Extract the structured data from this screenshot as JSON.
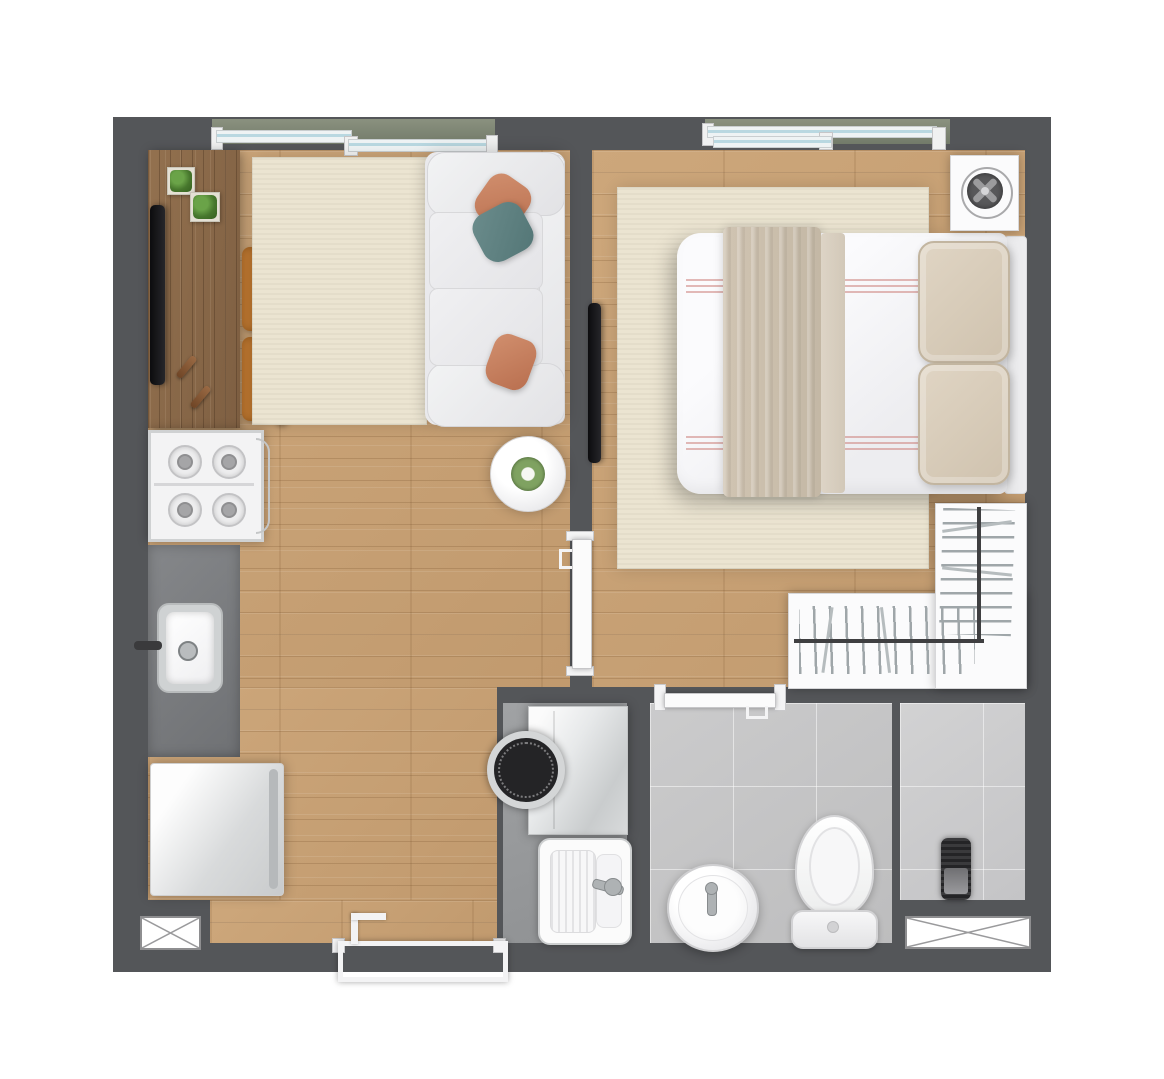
{
  "title": "one-bedroom-apartment-floor-plan",
  "palette": {
    "wall": "#545659",
    "wood": "#c9a377",
    "desk_wood": "#8a6a4c",
    "rug": "#ebe4d1",
    "sofa": "#e9e9ec",
    "terracotta": "#b96f4f",
    "teal": "#537676",
    "chair": "#a3631f",
    "counter": "#797b7e",
    "tile": "#c5c5c6",
    "laundry": "#97999b",
    "blanket": "#c4b8a5",
    "pillow_beige": "#cfc2ae",
    "mattress": "#f6f6f8",
    "balcony": "#7b8272",
    "glass": "#b9d8e1",
    "plant": "#4f8136",
    "appliance_dark": "#2e2e30",
    "frame_white": "#f4f4f5"
  },
  "scene": {
    "type": "top-down floor plan",
    "rooms": [
      {
        "name": "living-room",
        "floor": "wood",
        "furniture": [
          "media-sideboard",
          "tv",
          "potted-plant",
          "potted-plant",
          "remote-control",
          "remote-control",
          "dining-chair",
          "dining-chair",
          "area-rug",
          "sofa",
          "throw-pillow-terracotta",
          "throw-pillow-teal",
          "throw-pillow-terracotta",
          "coffee-table-with-plant"
        ]
      },
      {
        "name": "kitchen",
        "floor": "wood",
        "furniture": [
          "four-burner-cooktop",
          "countertop",
          "kitchen-sink",
          "refrigerator"
        ]
      },
      {
        "name": "bedroom",
        "floor": "wood",
        "furniture": [
          "area-rug",
          "double-bed",
          "blanket-runner",
          "bed-pillow",
          "bed-pillow",
          "headboard",
          "wall-tv",
          "side-table-with-fan",
          "l-shaped-wardrobe-with-hangers"
        ]
      },
      {
        "name": "laundry-area",
        "floor": "gray",
        "furniture": [
          "washing-machine",
          "laundry-tank"
        ]
      },
      {
        "name": "bathroom",
        "floor": "tile",
        "furniture": [
          "round-washbasin",
          "toilet"
        ]
      },
      {
        "name": "shower-area",
        "floor": "tile",
        "furniture": [
          "water-heater"
        ]
      }
    ],
    "openings": {
      "windows": [
        "living-room-sliding-window",
        "bedroom-sliding-window"
      ],
      "doors": [
        "bedroom-door",
        "bathroom-door",
        "entry-door"
      ],
      "service_shafts": [
        "bottom-left-shaft",
        "bottom-right-shaft"
      ]
    }
  }
}
